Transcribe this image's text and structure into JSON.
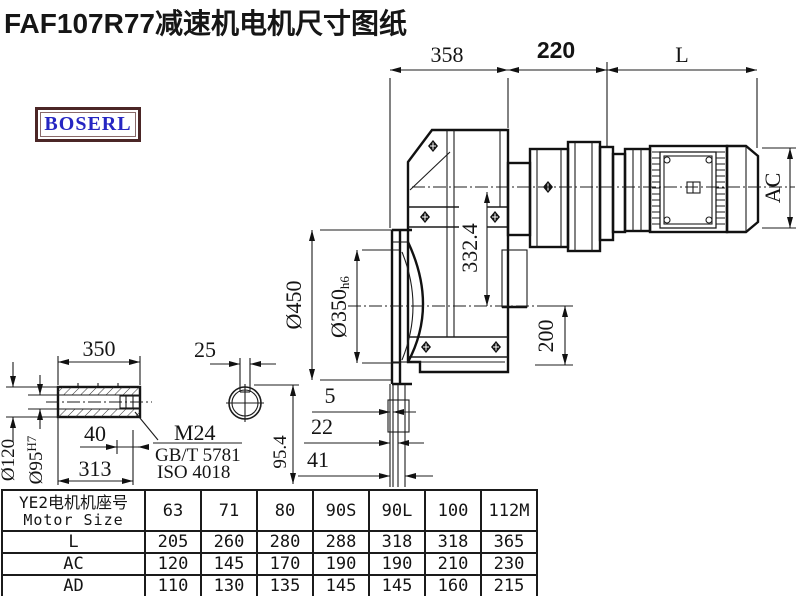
{
  "title": "FAF107R77减速机电机尺寸图纸",
  "logo": {
    "text": "BOSERL"
  },
  "drawing": {
    "dims": {
      "housing_width": "358",
      "adapter_length": "220",
      "motor_length": "L",
      "motor_diameter": "AC",
      "axis_height": "332.4",
      "output_center_height": "200",
      "flange_diameter": "Ø450",
      "spigot_diameter": "Ø350",
      "spigot_fit": "h6",
      "offset_a": "5",
      "offset_b": "22",
      "offset_c": "41",
      "sleeve_length": "350",
      "keyway_width": "25",
      "keyway_depth": "95.4",
      "sleeve_outer_diameter": "Ø120",
      "bore_diameter": "Ø95",
      "bore_fit": "H7",
      "thread_length": "40",
      "hub_length": "313",
      "thread_spec": "M24",
      "bolt_standard": "GB/T 5781",
      "iso_standard": "ISO 4018"
    }
  },
  "table": {
    "header_cn": "YE2电机机座号",
    "header_en": "Motor Size",
    "sizes": [
      "63",
      "71",
      "80",
      "90S",
      "90L",
      "100",
      "112M"
    ],
    "rows": [
      {
        "label": "L",
        "values": [
          "205",
          "260",
          "280",
          "288",
          "318",
          "318",
          "365"
        ]
      },
      {
        "label": "AC",
        "values": [
          "120",
          "145",
          "170",
          "190",
          "190",
          "210",
          "230"
        ]
      },
      {
        "label": "AD",
        "values": [
          "110",
          "130",
          "135",
          "145",
          "145",
          "160",
          "215"
        ]
      }
    ]
  }
}
